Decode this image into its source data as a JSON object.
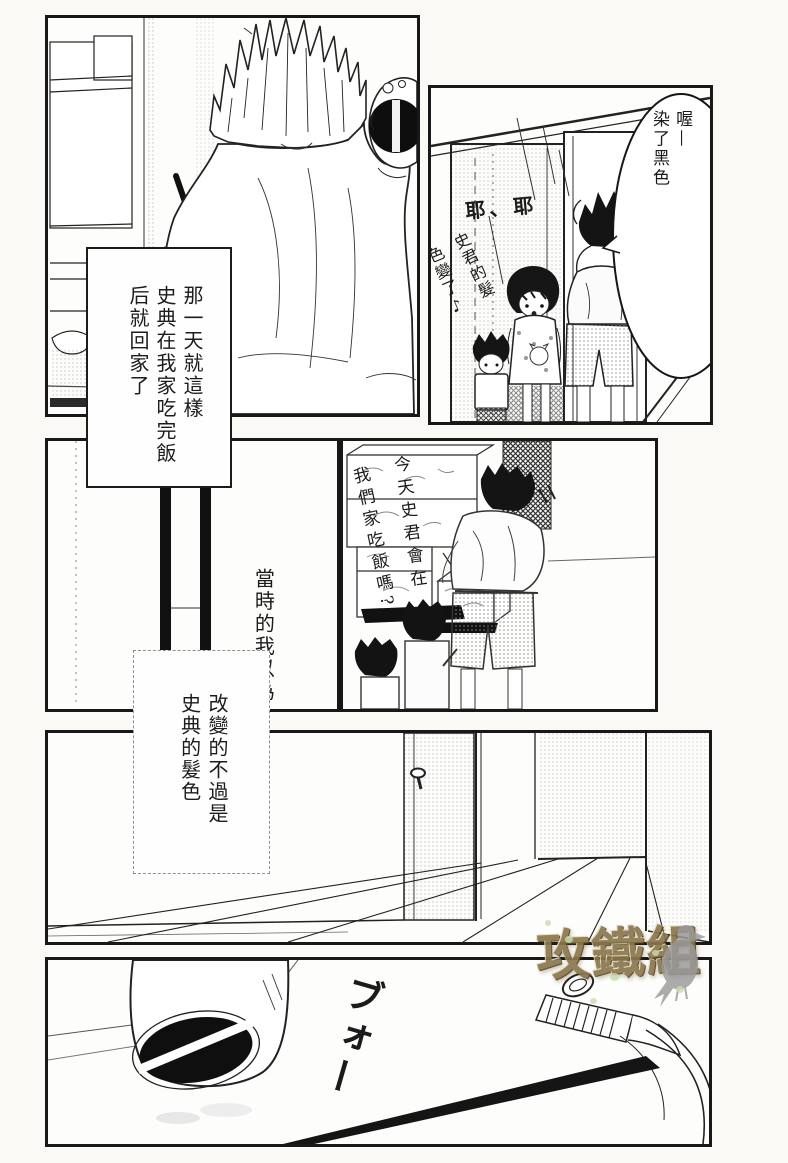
{
  "page": {
    "bg": "#faf9f6",
    "ink": "#1c1c1c"
  },
  "panel1": {
    "narration_cols": [
      "那一天就這樣",
      "史典在我家吃完飯",
      "后就回家了"
    ]
  },
  "panel2": {
    "bubble_cols": [
      "喔—",
      "染了黑色"
    ],
    "exclaim": "耶、耶",
    "hair_note_cols": [
      "史君的髮",
      "色變了♪"
    ]
  },
  "panel4": {
    "handwriting_cols": [
      "今天史君會在",
      "我們家吃飯嗎?"
    ]
  },
  "narration_mid": {
    "line": "當時的我以為",
    "box_cols": [
      "改變的不過是",
      "史典的髮色"
    ]
  },
  "panel6": {
    "sfx": "ブォー"
  },
  "watermark": {
    "text": "攻鐵組",
    "icon": "dove-icon",
    "text_color": "#8a774d",
    "dot_color": "#c9dcab",
    "bird_color": "#9a9a9a"
  }
}
